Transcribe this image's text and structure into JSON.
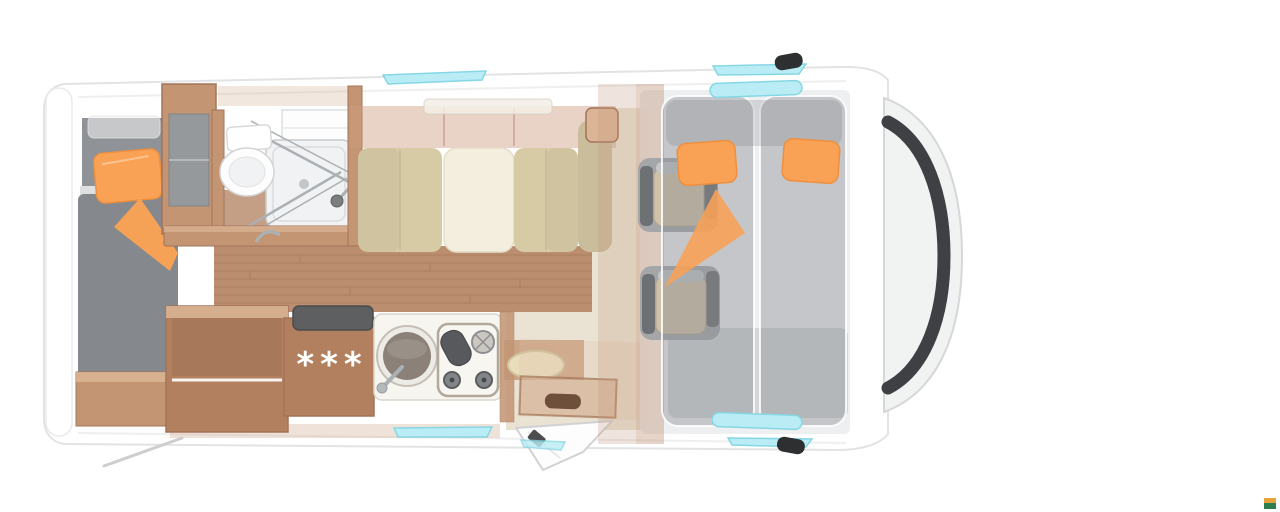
{
  "page": {
    "background": "#ffffff",
    "width": 1280,
    "height": 512
  },
  "scene": {
    "kind": "3d-top-view-floorplan-render",
    "subject": "semi-integrated motorhome interior layout, front of vehicle at right",
    "kitchen": {
      "fridge_rating": "***"
    },
    "regions": [
      "rear-single-bed",
      "bed-pillow",
      "bed-blanket-fold",
      "wardrobe",
      "bathroom",
      "toilet",
      "shower",
      "shower-glass-doors",
      "vanity-shelf",
      "dinette-left-bench",
      "dinette-table",
      "dinette-right-bench",
      "overhead-lockers",
      "wood-floor",
      "kitchen-counter",
      "fridge-freezer",
      "kitchen-sink",
      "stove",
      "entry-stool",
      "entry-step",
      "entry-door-open",
      "cab-seat-rear-facing-left",
      "cab-seat-rear-facing-right",
      "drop-down-cab-bed",
      "cab-bed-pillow-left",
      "cab-bed-pillow-right",
      "cab-bed-blanket-fold",
      "windshield",
      "hood",
      "wing-mirror-top",
      "wing-mirror-bottom",
      "roof-window-habitation",
      "roof-window-cab",
      "side-window-kitchen",
      "cab-door-windows",
      "awning-crank-handle",
      "watermark"
    ]
  },
  "colors": {
    "bg": "#ffffff",
    "body-stroke": "#e2e3e4",
    "wood": "#c39573",
    "wood-dark": "#a3735a",
    "wood-deep": "#b2805f",
    "wood-light": "#dbb696",
    "floor": "#bb8e70",
    "floor-line": "#9a6c4f",
    "mattress": "#85888c",
    "headboard": "#8f9296",
    "orange": "#f9a255",
    "orange-deep": "#ef8f3e",
    "cushion": "#d7cba6",
    "cushion-dark": "#c9bd9b",
    "table-cream": "#f3eedd",
    "cream": "#f7f5ef",
    "corridor": "#eae3d4",
    "sink-bowl": "#8b8178",
    "seat-beige": "#cfc2a9",
    "armrest": "#6e7174",
    "cab-base": "#ecedef",
    "bed-overlay": "rgba(134,138,143,0.40)",
    "cyan": "#b9ecf5",
    "cyan-border": "#86d7e4",
    "windshield": "#3e4044",
    "glass": "#f1f2f2",
    "trim": "#d6d7d8",
    "chrome": "#aab0b4",
    "dark": "#2e2f31",
    "locker-tan": "rgba(203,158,128,0.45)"
  },
  "watermark": {
    "top": "#e8a33d",
    "bottom": "#2e7d4f"
  }
}
